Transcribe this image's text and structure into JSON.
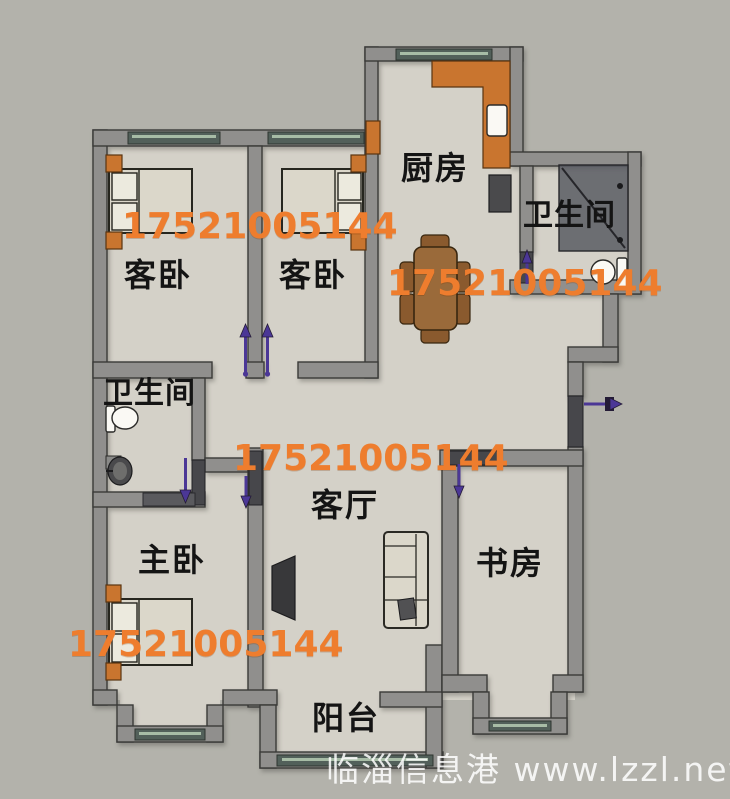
{
  "floor_plan": {
    "rooms": [
      {
        "id": "guest-bedroom-1",
        "label": "客卧"
      },
      {
        "id": "guest-bedroom-2",
        "label": "客卧"
      },
      {
        "id": "kitchen",
        "label": "厨房"
      },
      {
        "id": "bathroom-1",
        "label": "卫生间"
      },
      {
        "id": "bathroom-2",
        "label": "卫生间"
      },
      {
        "id": "master-bedroom",
        "label": "主卧"
      },
      {
        "id": "living-room",
        "label": "客厅"
      },
      {
        "id": "study",
        "label": "书房"
      },
      {
        "id": "balcony",
        "label": "阳台"
      }
    ],
    "watermark": {
      "phone": "17521005144",
      "site": "临淄信息港 www.lzzl.net"
    },
    "colors": {
      "background": "#b3b2ab",
      "floor": "#d4d1c8",
      "wall": "#908f8d",
      "wall_outline": "#3a3a38",
      "window": "#52605a",
      "window_glass": "#a7bca6",
      "door_leaf": "#47474b",
      "arrow": "#4b3796",
      "accent_orange": "#c9752f",
      "watermark_orange": "#ee7d2e",
      "table_brown": "#9a6a3a",
      "furniture_light": "#dbd7ca",
      "dark_fixture": "#4a4a4c"
    }
  }
}
